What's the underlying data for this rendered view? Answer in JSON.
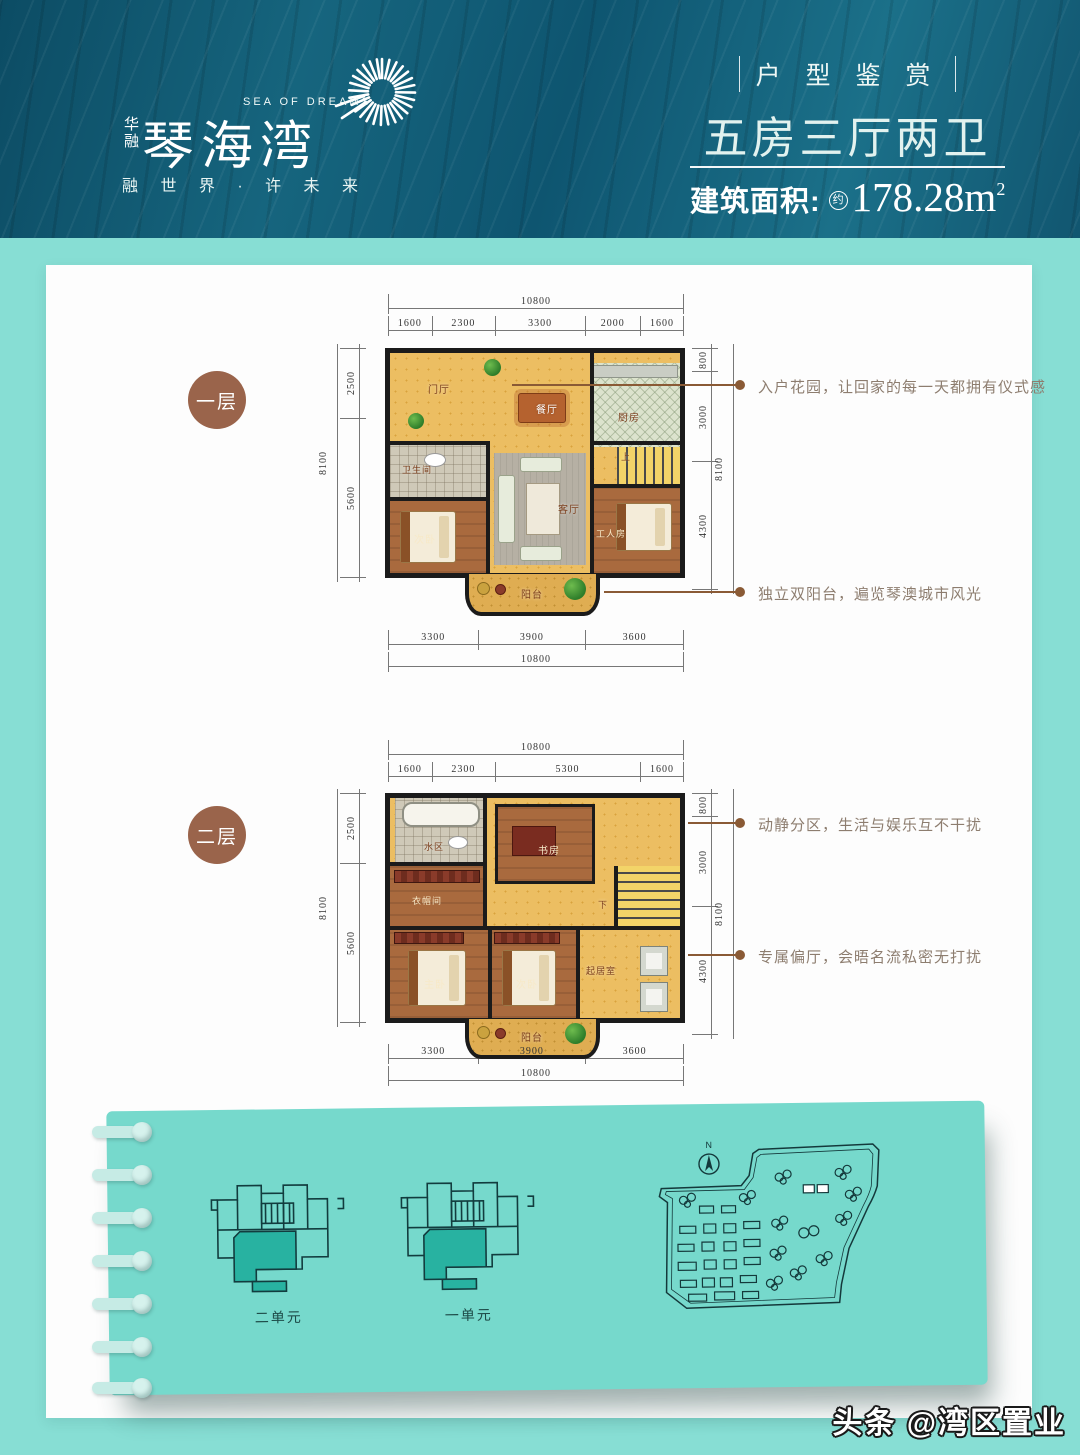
{
  "header": {
    "company_vertical": "华融",
    "brand": "琴海湾",
    "brand_en": "SEA OF DREAMS",
    "tagline": "融 世 界 · 许 未 来",
    "section_title": "户 型 鉴 赏",
    "unit_type": "五房三厅两卫",
    "area_label": "建筑面积:",
    "area_approx": "约",
    "area_value": "178.28m",
    "area_sup": "2"
  },
  "floors": [
    {
      "badge": "一层",
      "dims": {
        "top_total": "10800",
        "top": [
          "1600",
          "2300",
          "3300",
          "2000",
          "1600"
        ],
        "left_total": "8100",
        "left": [
          "2500",
          "5600"
        ],
        "right_total": "8100",
        "right": [
          "800",
          "3000",
          "4300"
        ],
        "bottom": [
          "3300",
          "3900",
          "3600"
        ],
        "bottom_total": "10800"
      },
      "rooms": {
        "entry": "门厅",
        "dining": "餐厅",
        "kitchen": "厨房",
        "bath": "卫生间",
        "bedroom2": "次卧",
        "living": "客厅",
        "maid_room": "工人房",
        "balcony": "阳台",
        "stairs": "上"
      },
      "annotations": [
        "入户花园，让回家的每一天都拥有仪式感",
        "独立双阳台，遍览琴澳城市风光"
      ]
    },
    {
      "badge": "二层",
      "dims": {
        "top_total": "10800",
        "top": [
          "1600",
          "2300",
          "5300",
          "1600"
        ],
        "left_total": "8100",
        "left": [
          "2500",
          "5600"
        ],
        "right_total": "8100",
        "right": [
          "800",
          "3000",
          "4300"
        ],
        "bottom": [
          "3300",
          "3900",
          "3600"
        ],
        "bottom_total": "10800"
      },
      "rooms": {
        "wet_area": "水区",
        "study": "书房",
        "cloakroom": "衣帽间",
        "master": "主卧",
        "bedroom2": "次卧",
        "sitting": "起居室",
        "balcony": "阳台",
        "stairs": "下"
      },
      "annotations": [
        "动静分区，生活与娱乐互不干扰",
        "专属偏厅，会晤名流私密无打扰"
      ]
    }
  ],
  "bottom_panel": {
    "unit_labels": [
      "二单元",
      "一单元"
    ],
    "compass_label": "N"
  },
  "watermark": "头条 @湾区置业",
  "colors": {
    "banner": "#11586F",
    "page_bg": "#87DED4",
    "panel_bg": "#76D9CC",
    "badge_brown": "#9A644B",
    "annotation_brown": "#8A5B36",
    "unit_highlight": "#28B2A1"
  }
}
